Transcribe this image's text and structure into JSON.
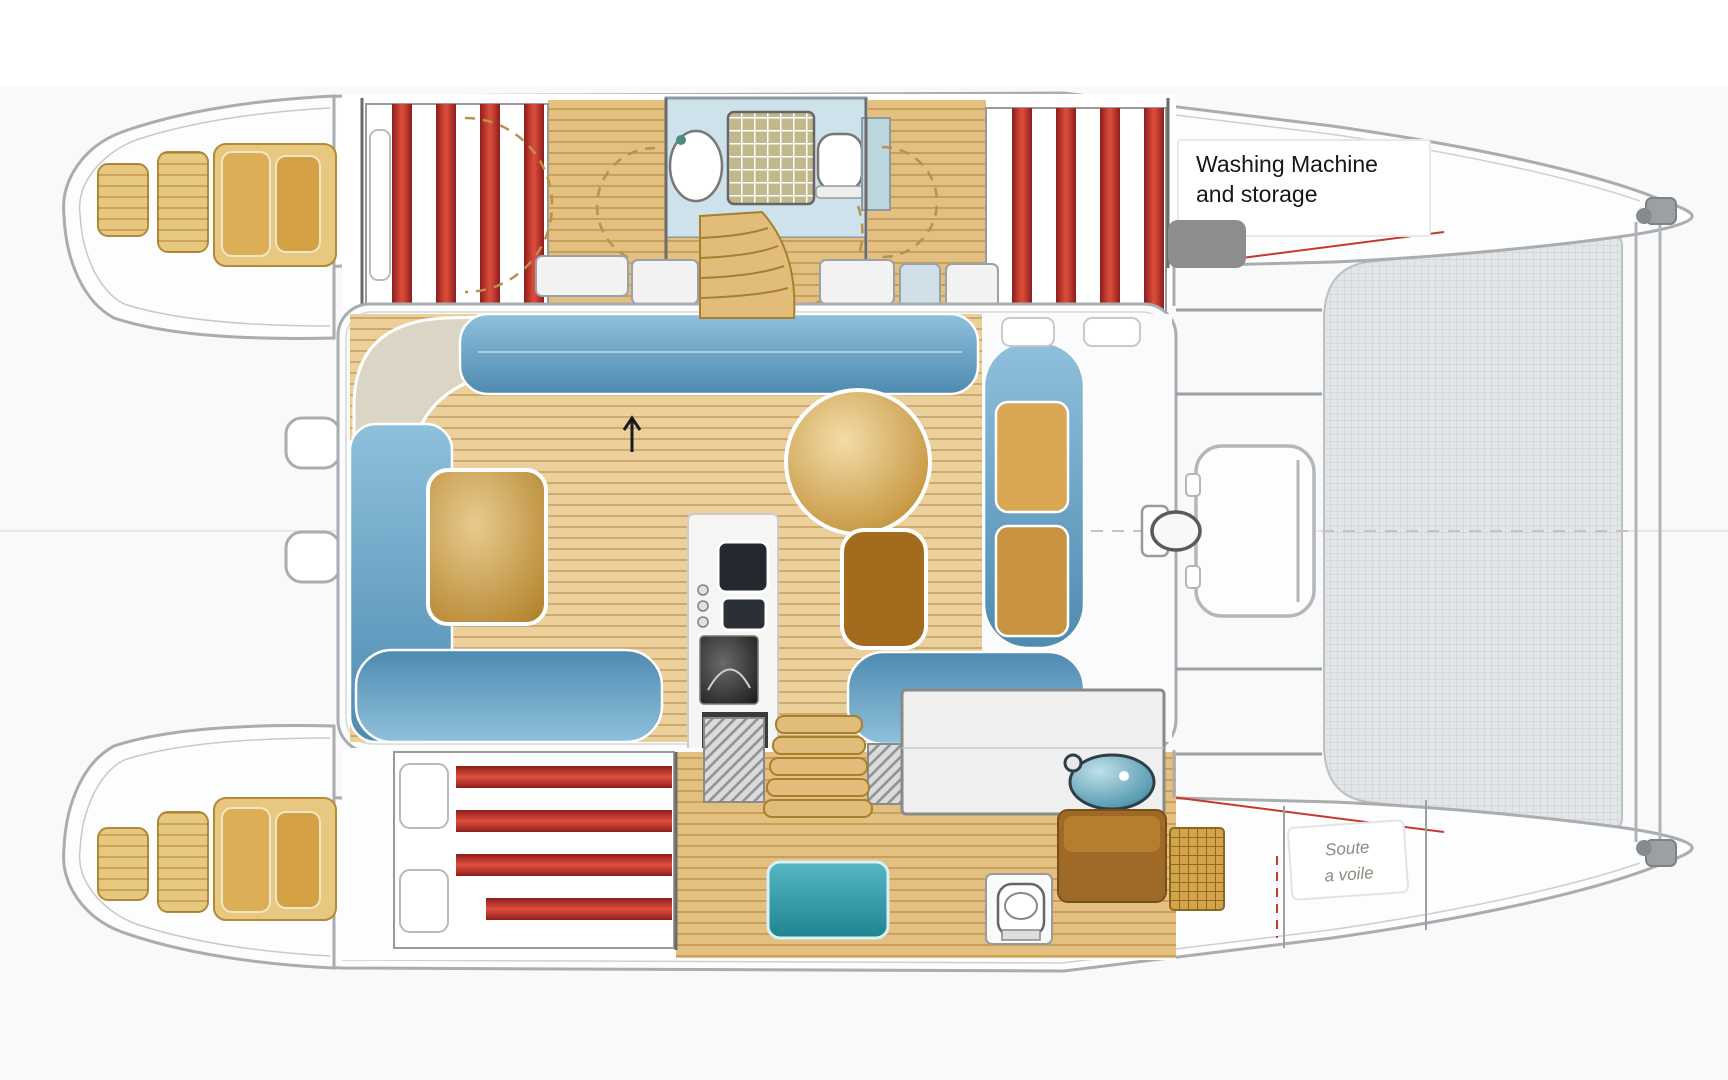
{
  "diagram": {
    "type": "catamaran-floor-plan",
    "orientation": "bow-right-stern-left"
  },
  "annotations": {
    "washing_machine": {
      "line1": "Washing Machine",
      "line2": "and storage"
    },
    "sail_locker": {
      "line1": "Soute",
      "line2": "a voile"
    }
  },
  "features": [
    "port-transom-steps",
    "starboard-transom-steps",
    "port-aft-cabin-striped-berth",
    "port-head-with-sink-shower-toilet",
    "port-forward-cabin-striped-berth",
    "washing-machine-storage-area",
    "cockpit-u-settee",
    "cockpit-table",
    "salon-settee",
    "salon-round-table",
    "salon-square-table",
    "galley-double-sink",
    "galley-stove",
    "companionway-stairs-port",
    "companionway-stairs-starboard",
    "starboard-aft-cabin-striped-berth",
    "starboard-head-sink",
    "starboard-toilet",
    "starboard-bench-seat",
    "sail-locker",
    "foredeck-seat",
    "mast-foot",
    "trampoline-net",
    "forward-crossbeam",
    "bow-fittings",
    "dinghy-davit-steps"
  ],
  "colors": {
    "outline": "#a9adb1",
    "wood_light": "#ecd09c",
    "wood_dark": "#ad7a20",
    "stripe_red": "#c0392b",
    "sofa_blue": "#63a1c4",
    "bench_teal": "#2f9fae",
    "bathroom_blue": "#cde2eb",
    "mesh_gray": "#e3e6e8",
    "redaction_gray": "#8d8d8d"
  }
}
